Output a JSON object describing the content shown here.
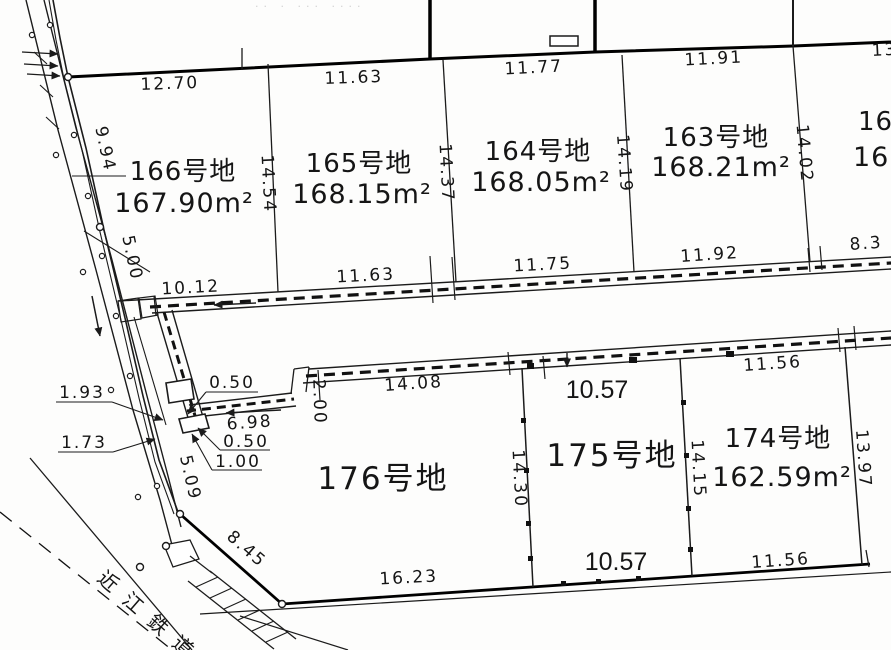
{
  "map": {
    "faint_top": "·· · ··· ····",
    "parcels": {
      "p166": {
        "name": "166号地",
        "area": "167.90m²"
      },
      "p165": {
        "name": "165号地",
        "area": "168.15m²"
      },
      "p164": {
        "name": "164号地",
        "area": "168.05m²"
      },
      "p163": {
        "name": "163号地",
        "area": "168.21m²"
      },
      "p162": {
        "name": "16",
        "area": "168"
      },
      "p176": {
        "name": "176号地"
      },
      "p175": {
        "name": "175号地"
      },
      "p174": {
        "name": "174号地",
        "area": "162.59m²"
      }
    },
    "dims": {
      "top_166": "12.70",
      "top_165": "11.63",
      "top_164": "11.77",
      "top_163": "11.91",
      "top_162_cut": "13",
      "west_upper": "9.94",
      "west_lower": "5.00",
      "side_166_165": "14.54",
      "side_165_164": "14.37",
      "side_164_163": "14.19",
      "side_163_162": "14.02",
      "bot_166": "10.12",
      "bot_165": "11.63",
      "bot_164": "11.75",
      "bot_163": "11.92",
      "bot_162_cut": "8.3",
      "ditch_w_upper": "0.50",
      "ditch_6_98": "6.98",
      "ditch_w_lower": "0.50",
      "offset_1_00": "1.00",
      "offset_1_93": "1.93",
      "offset_1_73": "1.73",
      "road_5_09": "5.09",
      "jog_2_00": "2.00",
      "strip_14_08": "14.08",
      "top_175": "10.57",
      "top_174": "11.56",
      "side_176_175": "14.30",
      "side_175_174": "14.15",
      "side_174_east": "13.97",
      "bot_175": "10.57",
      "bot_174": "11.56",
      "bot_176": "16.23",
      "diag_176": "8.45"
    },
    "railway": {
      "label": "近江鉄道"
    }
  }
}
